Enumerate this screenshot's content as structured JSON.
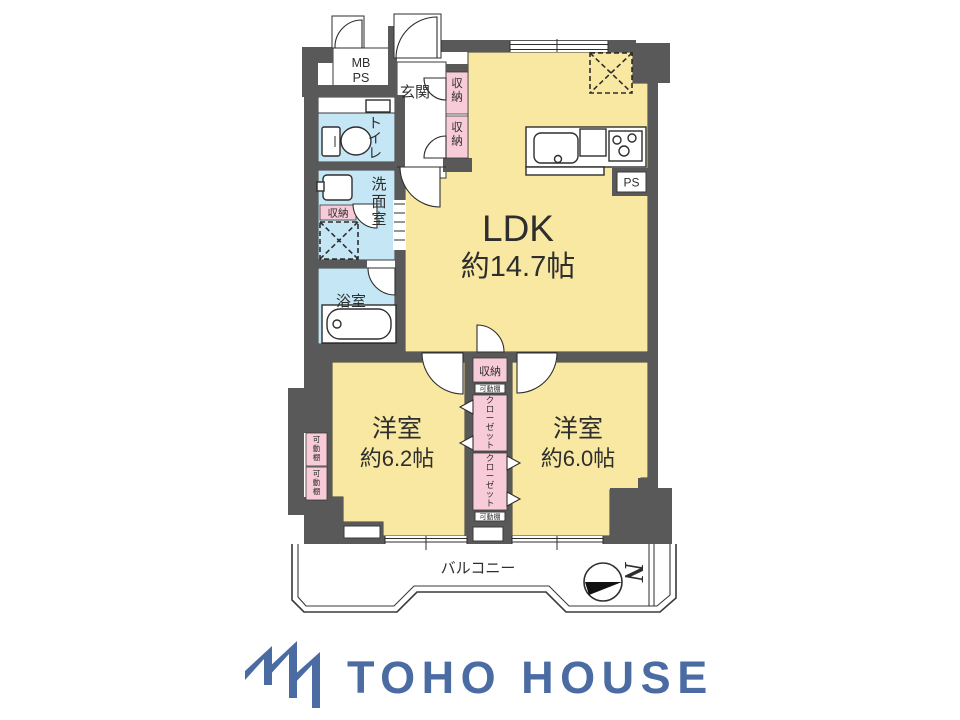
{
  "colors": {
    "wall_gray": "#595959",
    "room_yellow": "#f8e8a2",
    "wet_area_blue": "#c5e7f5",
    "closet_pink": "#f7cbd7",
    "brand_blue": "#4b6ba3"
  },
  "plan": {
    "rooms": {
      "ldk": {
        "name": "LDK",
        "size": "約14.7帖"
      },
      "bedroom_west": {
        "name": "洋室",
        "size": "約6.2帖"
      },
      "bedroom_east": {
        "name": "洋室",
        "size": "約6.0帖"
      },
      "entrance": {
        "name": "玄関"
      },
      "toilet": {
        "name": "トイレ"
      },
      "washroom": {
        "name": "洗面室"
      },
      "bathroom": {
        "name": "浴室"
      },
      "balcony": {
        "name": "バルコニー"
      }
    },
    "labels": {
      "mb": "MB",
      "ps": "PS",
      "storage": "収納",
      "closet": "クローゼット",
      "movable_shelf": "可動棚",
      "north": "N"
    }
  },
  "footer": {
    "brand": "TOHO HOUSE"
  }
}
